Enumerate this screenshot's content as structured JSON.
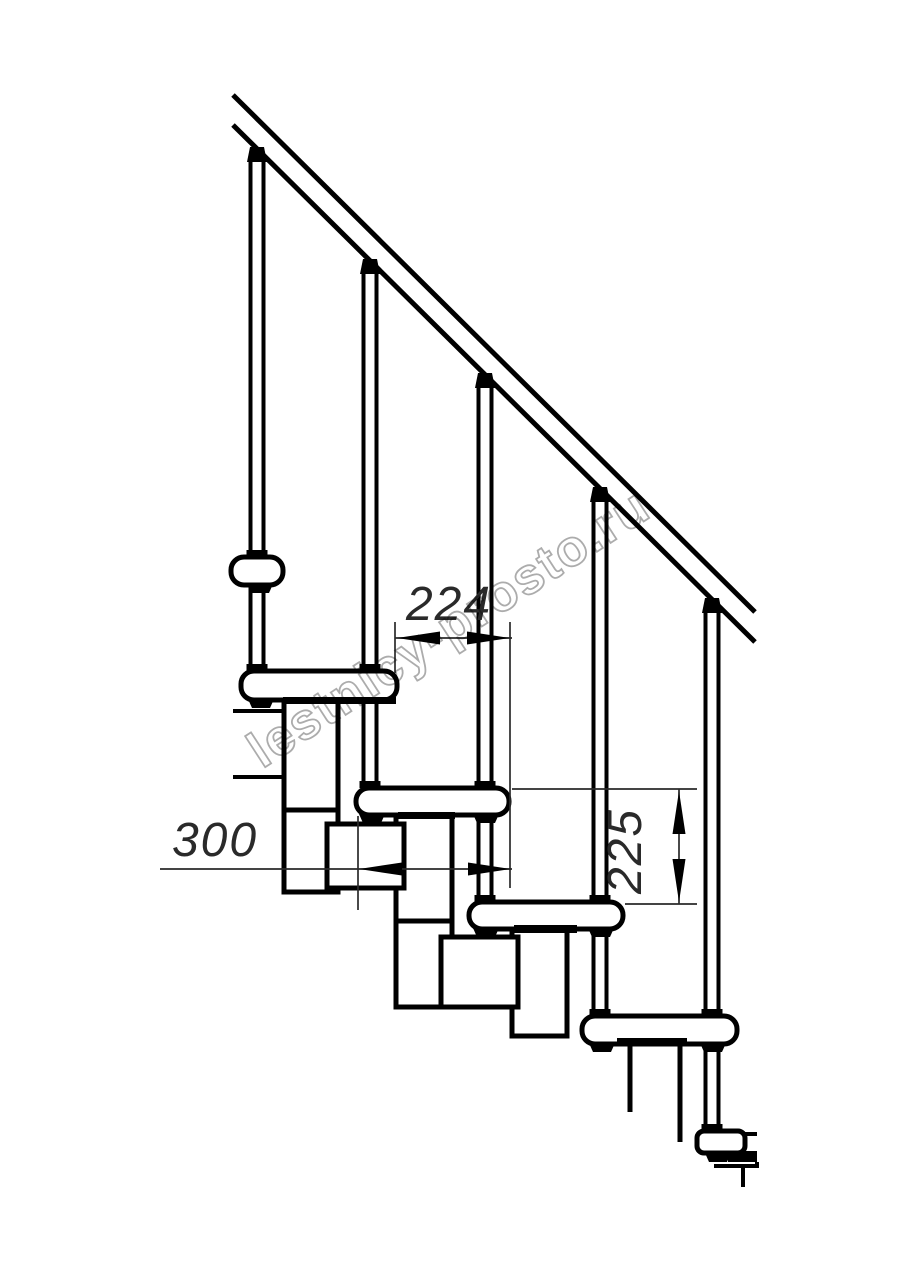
{
  "drawing": {
    "type": "technical-drawing",
    "subject": "modular staircase side elevation",
    "watermark": "lestnicy-prosto.ru",
    "dimensions": {
      "step_run": "224",
      "tread_depth": "300",
      "step_rise": "225"
    },
    "colors": {
      "line": "#000000",
      "dim": "#2a2a2a",
      "watermark": "#9e9e9e",
      "bg": "#ffffff"
    }
  }
}
